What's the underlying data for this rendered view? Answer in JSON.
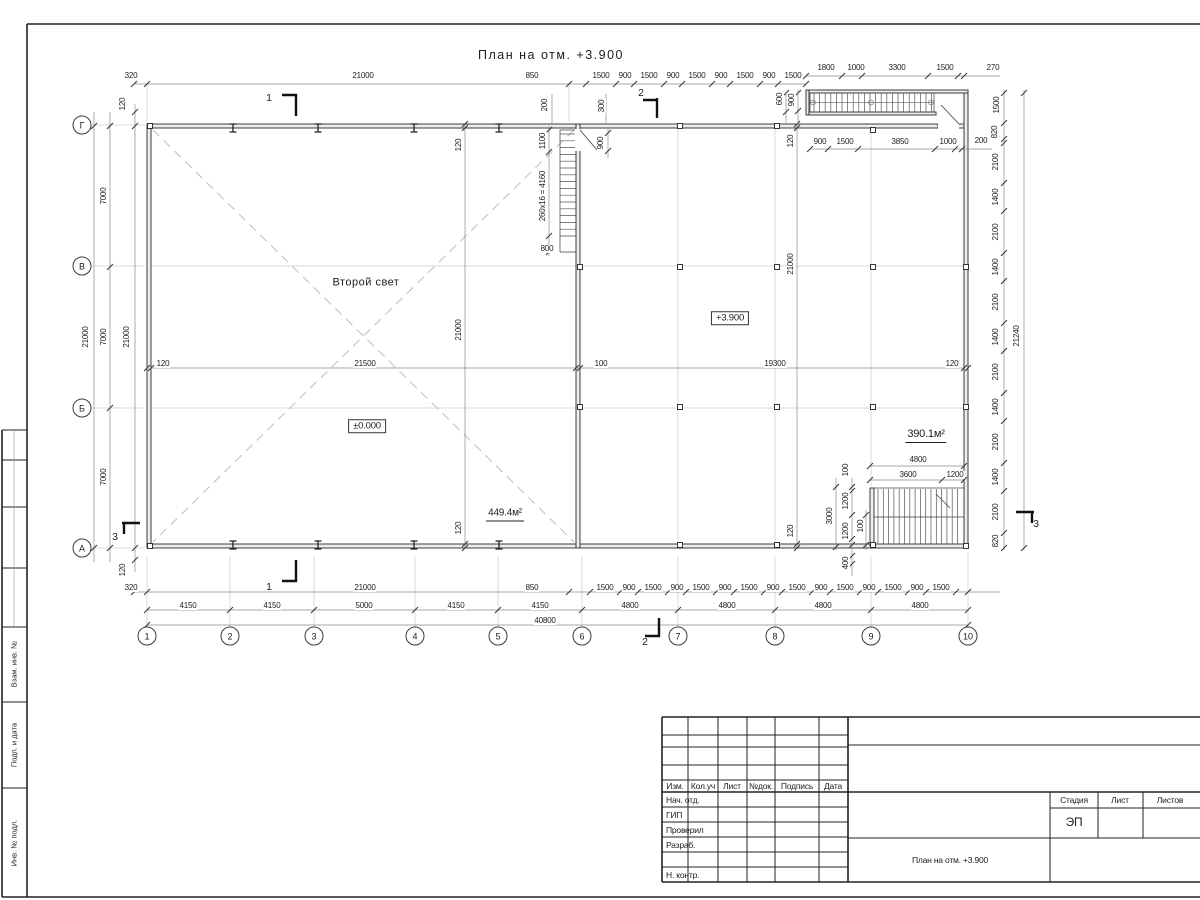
{
  "title": "План на отм. +3.900",
  "colors": {
    "wall": "#3c3c3c",
    "dim": "#8a8a8a",
    "tick": "#3a3a3a",
    "axis": "#c9c9c9",
    "hatch": "#555555"
  },
  "axes": {
    "rows": [
      {
        "name": "Г",
        "x": 82,
        "y": 125
      },
      {
        "name": "В",
        "x": 82,
        "y": 266
      },
      {
        "name": "Б",
        "x": 82,
        "y": 408
      },
      {
        "name": "А",
        "x": 82,
        "y": 548
      }
    ],
    "cols": [
      {
        "name": "1",
        "x": 147,
        "y": 636
      },
      {
        "name": "2",
        "x": 230,
        "y": 636
      },
      {
        "name": "3",
        "x": 314,
        "y": 636
      },
      {
        "name": "4",
        "x": 415,
        "y": 636
      },
      {
        "name": "5",
        "x": 498,
        "y": 636
      },
      {
        "name": "6",
        "x": 582,
        "y": 636
      },
      {
        "name": "7",
        "x": 678,
        "y": 636
      },
      {
        "name": "8",
        "x": 775,
        "y": 636
      },
      {
        "name": "9",
        "x": 871,
        "y": 636
      },
      {
        "name": "10",
        "x": 968,
        "y": 636
      }
    ]
  },
  "annotations": [
    {
      "t": "План на отм. +3.900",
      "x": 551,
      "y": 55,
      "c": "ttl"
    },
    {
      "t": "Второй свет",
      "x": 366,
      "y": 283,
      "c": "big"
    },
    {
      "t": "±0.000",
      "x": 367,
      "y": 426,
      "c": "box"
    },
    {
      "t": "+3.900",
      "x": 730,
      "y": 318,
      "c": "box"
    },
    {
      "t": "449.4м²",
      "x": 505,
      "y": 515,
      "c": "und"
    },
    {
      "t": "390.1м²",
      "x": 926,
      "y": 436,
      "c": "und2"
    },
    {
      "t": "1",
      "x": 269,
      "y": 98,
      "c": "sec"
    },
    {
      "t": "1",
      "x": 269,
      "y": 587,
      "c": "sec"
    },
    {
      "t": "2",
      "x": 641,
      "y": 93,
      "c": "sec"
    },
    {
      "t": "2",
      "x": 645,
      "y": 642,
      "c": "sec"
    },
    {
      "t": "3",
      "x": 115,
      "y": 537,
      "c": "sec"
    },
    {
      "t": "3",
      "x": 1036,
      "y": 524,
      "c": "sec"
    }
  ],
  "dim_labels": [
    {
      "t": "320",
      "x": 131,
      "y": 76
    },
    {
      "t": "21000",
      "x": 363,
      "y": 76
    },
    {
      "t": "850",
      "x": 532,
      "y": 76
    },
    {
      "t": "1500",
      "x": 601,
      "y": 76
    },
    {
      "t": "900",
      "x": 625,
      "y": 76
    },
    {
      "t": "1500",
      "x": 649,
      "y": 76
    },
    {
      "t": "900",
      "x": 673,
      "y": 76
    },
    {
      "t": "1500",
      "x": 697,
      "y": 76
    },
    {
      "t": "900",
      "x": 721,
      "y": 76
    },
    {
      "t": "1500",
      "x": 745,
      "y": 76
    },
    {
      "t": "900",
      "x": 769,
      "y": 76
    },
    {
      "t": "1500",
      "x": 793,
      "y": 76
    },
    {
      "t": "1800",
      "x": 826,
      "y": 68
    },
    {
      "t": "1000",
      "x": 856,
      "y": 68
    },
    {
      "t": "3300",
      "x": 897,
      "y": 68
    },
    {
      "t": "1500",
      "x": 945,
      "y": 68
    },
    {
      "t": "270",
      "x": 993,
      "y": 68
    },
    {
      "t": "900",
      "x": 820,
      "y": 142
    },
    {
      "t": "1500",
      "x": 845,
      "y": 142
    },
    {
      "t": "3850",
      "x": 900,
      "y": 142
    },
    {
      "t": "1000",
      "x": 948,
      "y": 142
    },
    {
      "t": "200",
      "x": 981,
      "y": 141
    },
    {
      "t": "1500",
      "x": 997,
      "y": 105,
      "r": 1
    },
    {
      "t": "820",
      "x": 995,
      "y": 132,
      "r": 1
    },
    {
      "t": "2100",
      "x": 996,
      "y": 162,
      "r": 1
    },
    {
      "t": "1400",
      "x": 996,
      "y": 197,
      "r": 1
    },
    {
      "t": "2100",
      "x": 996,
      "y": 232,
      "r": 1
    },
    {
      "t": "1400",
      "x": 996,
      "y": 267,
      "r": 1
    },
    {
      "t": "2100",
      "x": 996,
      "y": 302,
      "r": 1
    },
    {
      "t": "1400",
      "x": 996,
      "y": 337,
      "r": 1
    },
    {
      "t": "2100",
      "x": 996,
      "y": 372,
      "r": 1
    },
    {
      "t": "1400",
      "x": 996,
      "y": 407,
      "r": 1
    },
    {
      "t": "2100",
      "x": 996,
      "y": 442,
      "r": 1
    },
    {
      "t": "1400",
      "x": 996,
      "y": 477,
      "r": 1
    },
    {
      "t": "2100",
      "x": 996,
      "y": 512,
      "r": 1
    },
    {
      "t": "820",
      "x": 996,
      "y": 541,
      "r": 1
    },
    {
      "t": "21240",
      "x": 1017,
      "y": 336,
      "r": 1
    },
    {
      "t": "120",
      "x": 123,
      "y": 104,
      "r": 1
    },
    {
      "t": "120",
      "x": 123,
      "y": 570,
      "r": 1
    },
    {
      "t": "7000",
      "x": 104,
      "y": 196,
      "r": 1
    },
    {
      "t": "7000",
      "x": 104,
      "y": 337,
      "r": 1
    },
    {
      "t": "7000",
      "x": 104,
      "y": 477,
      "r": 1
    },
    {
      "t": "21000",
      "x": 86,
      "y": 337,
      "r": 1
    },
    {
      "t": "21000",
      "x": 127,
      "y": 337,
      "r": 1
    },
    {
      "t": "200",
      "x": 545,
      "y": 105,
      "r": 1
    },
    {
      "t": "300",
      "x": 602,
      "y": 106,
      "r": 1
    },
    {
      "t": "1100",
      "x": 543,
      "y": 141,
      "r": 1
    },
    {
      "t": "260x16 = 4160",
      "x": 543,
      "y": 196,
      "r": 1
    },
    {
      "t": "900",
      "x": 601,
      "y": 143,
      "r": 1
    },
    {
      "t": "800",
      "x": 547,
      "y": 249
    },
    {
      "t": "600",
      "x": 780,
      "y": 99,
      "r": 1
    },
    {
      "t": "900",
      "x": 792,
      "y": 100,
      "r": 1
    },
    {
      "t": "120",
      "x": 459,
      "y": 145,
      "r": 1
    },
    {
      "t": "21000",
      "x": 459,
      "y": 330,
      "r": 1
    },
    {
      "t": "120",
      "x": 459,
      "y": 528,
      "r": 1
    },
    {
      "t": "120",
      "x": 791,
      "y": 141,
      "r": 1
    },
    {
      "t": "21000",
      "x": 791,
      "y": 264,
      "r": 1
    },
    {
      "t": "120",
      "x": 791,
      "y": 531,
      "r": 1
    },
    {
      "t": "120",
      "x": 163,
      "y": 364
    },
    {
      "t": "21500",
      "x": 365,
      "y": 364
    },
    {
      "t": "100",
      "x": 601,
      "y": 364
    },
    {
      "t": "19300",
      "x": 775,
      "y": 364
    },
    {
      "t": "120",
      "x": 952,
      "y": 364
    },
    {
      "t": "4800",
      "x": 918,
      "y": 460
    },
    {
      "t": "3600",
      "x": 908,
      "y": 475
    },
    {
      "t": "1200",
      "x": 955,
      "y": 475
    },
    {
      "t": "100",
      "x": 846,
      "y": 470,
      "r": 1
    },
    {
      "t": "1200",
      "x": 846,
      "y": 501,
      "r": 1
    },
    {
      "t": "1200",
      "x": 846,
      "y": 531,
      "r": 1
    },
    {
      "t": "3000",
      "x": 830,
      "y": 516,
      "r": 1
    },
    {
      "t": "100",
      "x": 861,
      "y": 526,
      "r": 1
    },
    {
      "t": "400",
      "x": 846,
      "y": 563,
      "r": 1
    },
    {
      "t": "320",
      "x": 131,
      "y": 588
    },
    {
      "t": "21000",
      "x": 365,
      "y": 588
    },
    {
      "t": "850",
      "x": 532,
      "y": 588
    },
    {
      "t": "1500",
      "x": 605,
      "y": 588
    },
    {
      "t": "900",
      "x": 629,
      "y": 588
    },
    {
      "t": "1500",
      "x": 653,
      "y": 588
    },
    {
      "t": "900",
      "x": 677,
      "y": 588
    },
    {
      "t": "1500",
      "x": 701,
      "y": 588
    },
    {
      "t": "900",
      "x": 725,
      "y": 588
    },
    {
      "t": "1500",
      "x": 749,
      "y": 588
    },
    {
      "t": "900",
      "x": 773,
      "y": 588
    },
    {
      "t": "1500",
      "x": 797,
      "y": 588
    },
    {
      "t": "900",
      "x": 821,
      "y": 588
    },
    {
      "t": "1500",
      "x": 845,
      "y": 588
    },
    {
      "t": "900",
      "x": 869,
      "y": 588
    },
    {
      "t": "1500",
      "x": 893,
      "y": 588
    },
    {
      "t": "900",
      "x": 917,
      "y": 588
    },
    {
      "t": "1500",
      "x": 941,
      "y": 588
    },
    {
      "t": "4150",
      "x": 188,
      "y": 606
    },
    {
      "t": "4150",
      "x": 272,
      "y": 606
    },
    {
      "t": "5000",
      "x": 364,
      "y": 606
    },
    {
      "t": "4150",
      "x": 456,
      "y": 606
    },
    {
      "t": "4150",
      "x": 540,
      "y": 606
    },
    {
      "t": "4800",
      "x": 630,
      "y": 606
    },
    {
      "t": "4800",
      "x": 727,
      "y": 606
    },
    {
      "t": "4800",
      "x": 823,
      "y": 606
    },
    {
      "t": "4800",
      "x": 920,
      "y": 606
    },
    {
      "t": "40800",
      "x": 545,
      "y": 621
    }
  ],
  "titleblock": {
    "header": [
      "Изм.",
      "Кол.уч",
      "Лист",
      "№док.",
      "Подпись",
      "Дата"
    ],
    "roles": [
      "Нач. отд.",
      "ГИП",
      "Проверил",
      "Разраб.",
      "",
      "Н. контр."
    ],
    "stage_label": "Стадия",
    "sheet_label": "Лист",
    "sheets_label": "Листов",
    "stage_value": "ЭП",
    "doc_title": "План на отм. +3.900"
  },
  "stamp_left": [
    "Взам. инв. №",
    "Подп. и дата",
    "Инв. № подл."
  ]
}
